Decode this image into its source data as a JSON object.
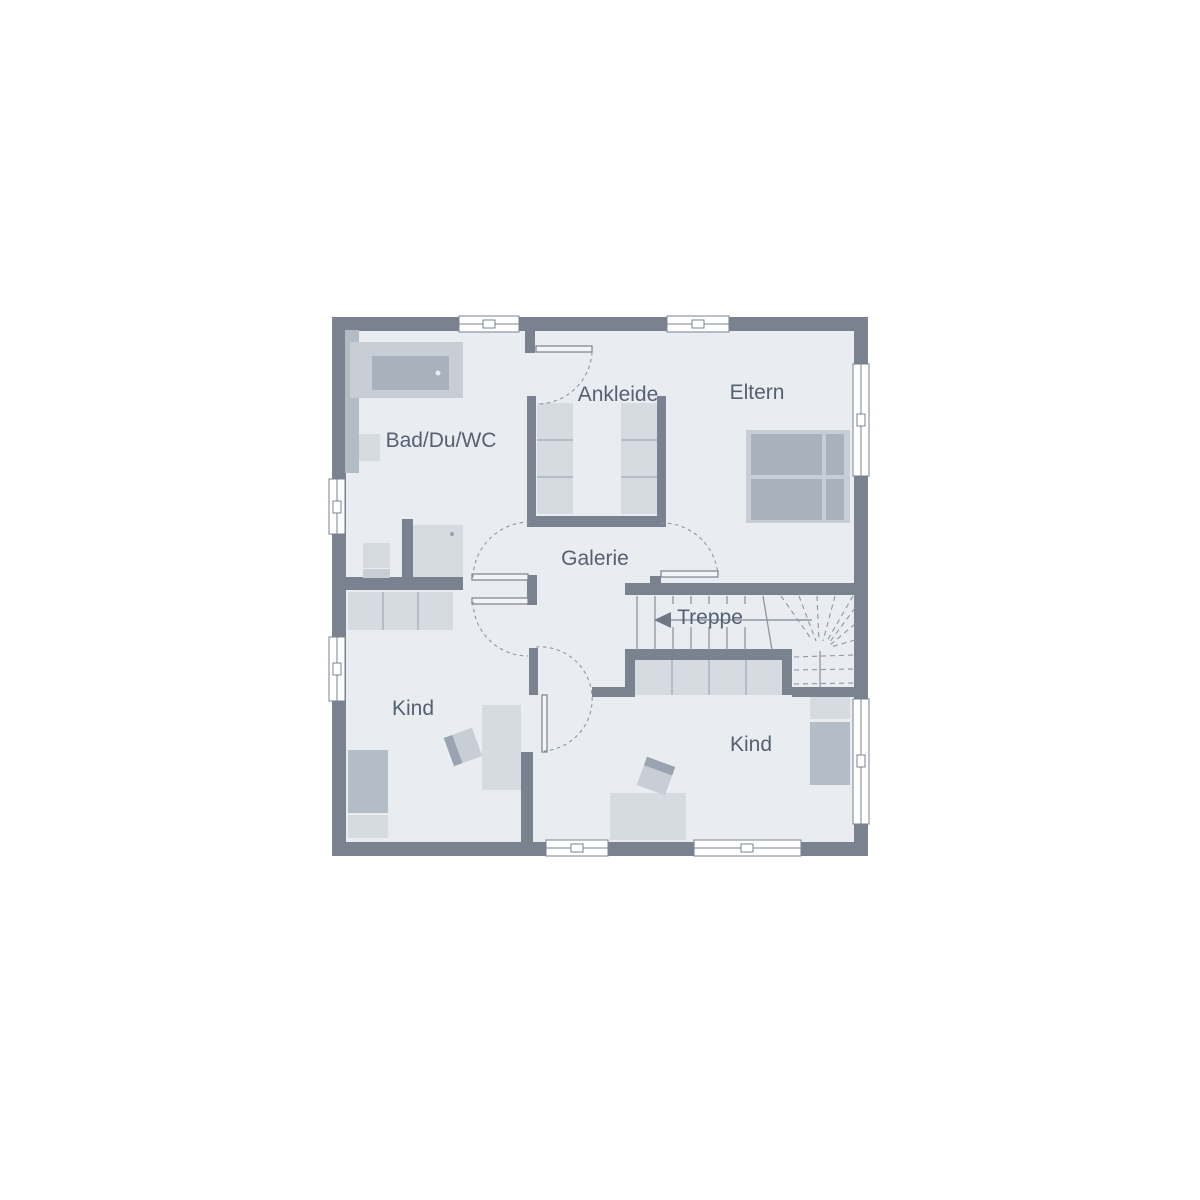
{
  "plan": {
    "rooms": {
      "bath": {
        "label": "Bad/Du/WC"
      },
      "dressing": {
        "label": "Ankleide"
      },
      "parents": {
        "label": "Eltern"
      },
      "gallery": {
        "label": "Galerie"
      },
      "stairs": {
        "label": "Treppe"
      },
      "child_left": {
        "label": "Kind"
      },
      "child_right": {
        "label": "Kind"
      }
    },
    "colors": {
      "bg": "#ffffff",
      "wall": "#7a8290",
      "floor": "#e9edf2",
      "prewall": "#b3bbc5",
      "furn_light": "#d6dae1",
      "furn_med": "#c8ced6",
      "furn_dark": "#a9b1bc",
      "furn_mid2": "#b4bcc6",
      "divline": "#aab2bd",
      "line": "#8e96a3",
      "label_color": "#556070",
      "window_fill": "#ffffff",
      "leaf_fill": "#f2f4f7"
    }
  }
}
